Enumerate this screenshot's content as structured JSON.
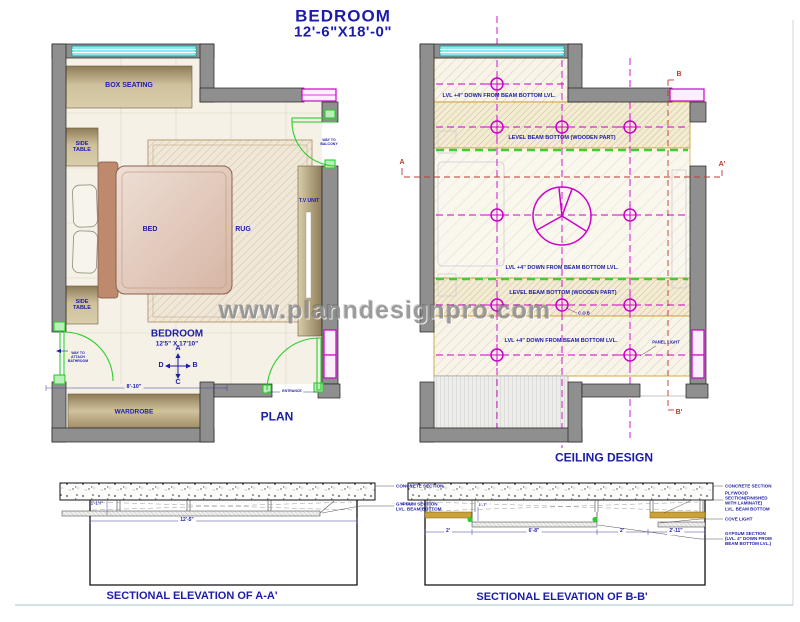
{
  "title": {
    "name": "BEDROOM",
    "size": "12'-6\"X18'-0\""
  },
  "watermark": "www.planndesignpro.com",
  "plan": {
    "caption": "PLAN",
    "room": {
      "name": "BEDROOM",
      "size": "12'5\" X 17'10\""
    },
    "furniture": {
      "box_seating": "BOX SEATING",
      "side_table_top": "SIDE\nTABLE",
      "side_table_bottom": "SIDE\nTABLE",
      "bed": "BED",
      "rug": "RUG",
      "tv_unit": "T.V UNIT",
      "wardrobe": "WARDROBE"
    },
    "doors": {
      "bathroom": "WAY TO\nATTACH\nBATHROOM",
      "balcony": "WAY TO\nBALCONY",
      "entrance": "ENTRANCE"
    },
    "compass": {
      "up": "A",
      "right": "B",
      "down": "C",
      "left": "D"
    },
    "dims": {
      "wardrobe_wall": "8'-10\""
    }
  },
  "ceiling": {
    "caption": "CEILING DESIGN",
    "labels": {
      "lvl_top": "LVL +4\" DOWN FROM BEAM BOTTOM LVL.",
      "beam_top": "LEVEL BEAM BOTTOM (WOODEN PART)",
      "lvl_mid": "LVL +4\" DOWN FROM BEAM BOTTOM LVL.",
      "beam_mid": "LEVEL BEAM BOTTOM (WOODEN PART)",
      "cob": "C.O.B",
      "lvl_bottom": "LVL +4\" DOWN FROM BEAM BOTTOM LVL.",
      "panel_light": "PANEL LIGHT"
    },
    "markers": {
      "a": "A",
      "a_prime": "A'",
      "b": "B",
      "b_prime": "B'"
    }
  },
  "section_a": {
    "caption": "SECTIONAL ELEVATION OF A-A'",
    "dims": {
      "height": "1'-1½\"",
      "width": "12'-5\""
    },
    "labels": {
      "concrete": "CONCRETE SECTION",
      "gypsum": "GYPSUM SECTION\nLVL. BEAM BOTTOM"
    }
  },
  "section_b": {
    "caption": "SECTIONAL ELEVATION OF B-B'",
    "dims": {
      "h1": "1'-1½\"",
      "h2": "1'-7\"",
      "w1": "2'",
      "w2": "6'-8\"",
      "w3": "2'",
      "w4": "2'-11\""
    },
    "labels": {
      "concrete": "CONCRETE SECTION",
      "plywood": "PLYWOOD\nSECTION(FINISHED\nWITH LAMINATE)\nLVL. BEAM BOTTOM",
      "cove": "COVE LIGHT",
      "gypsum": "GYPSUM SECTION\n(LVL. 4\" DOWN FROM\nBEAM BOTTOM LVL.)"
    }
  },
  "colors": {
    "text_blue": "#1c1ca8",
    "marker_red": "#c0392b",
    "door_green": "#2ecc2e",
    "ceiling_magenta": "#cc00cc",
    "window_cyan": "#8ee9ec",
    "zone_border_orange": "#c8941e",
    "wall_gray": "#8f8f8f",
    "plywood_gold": "#c9a23c"
  }
}
